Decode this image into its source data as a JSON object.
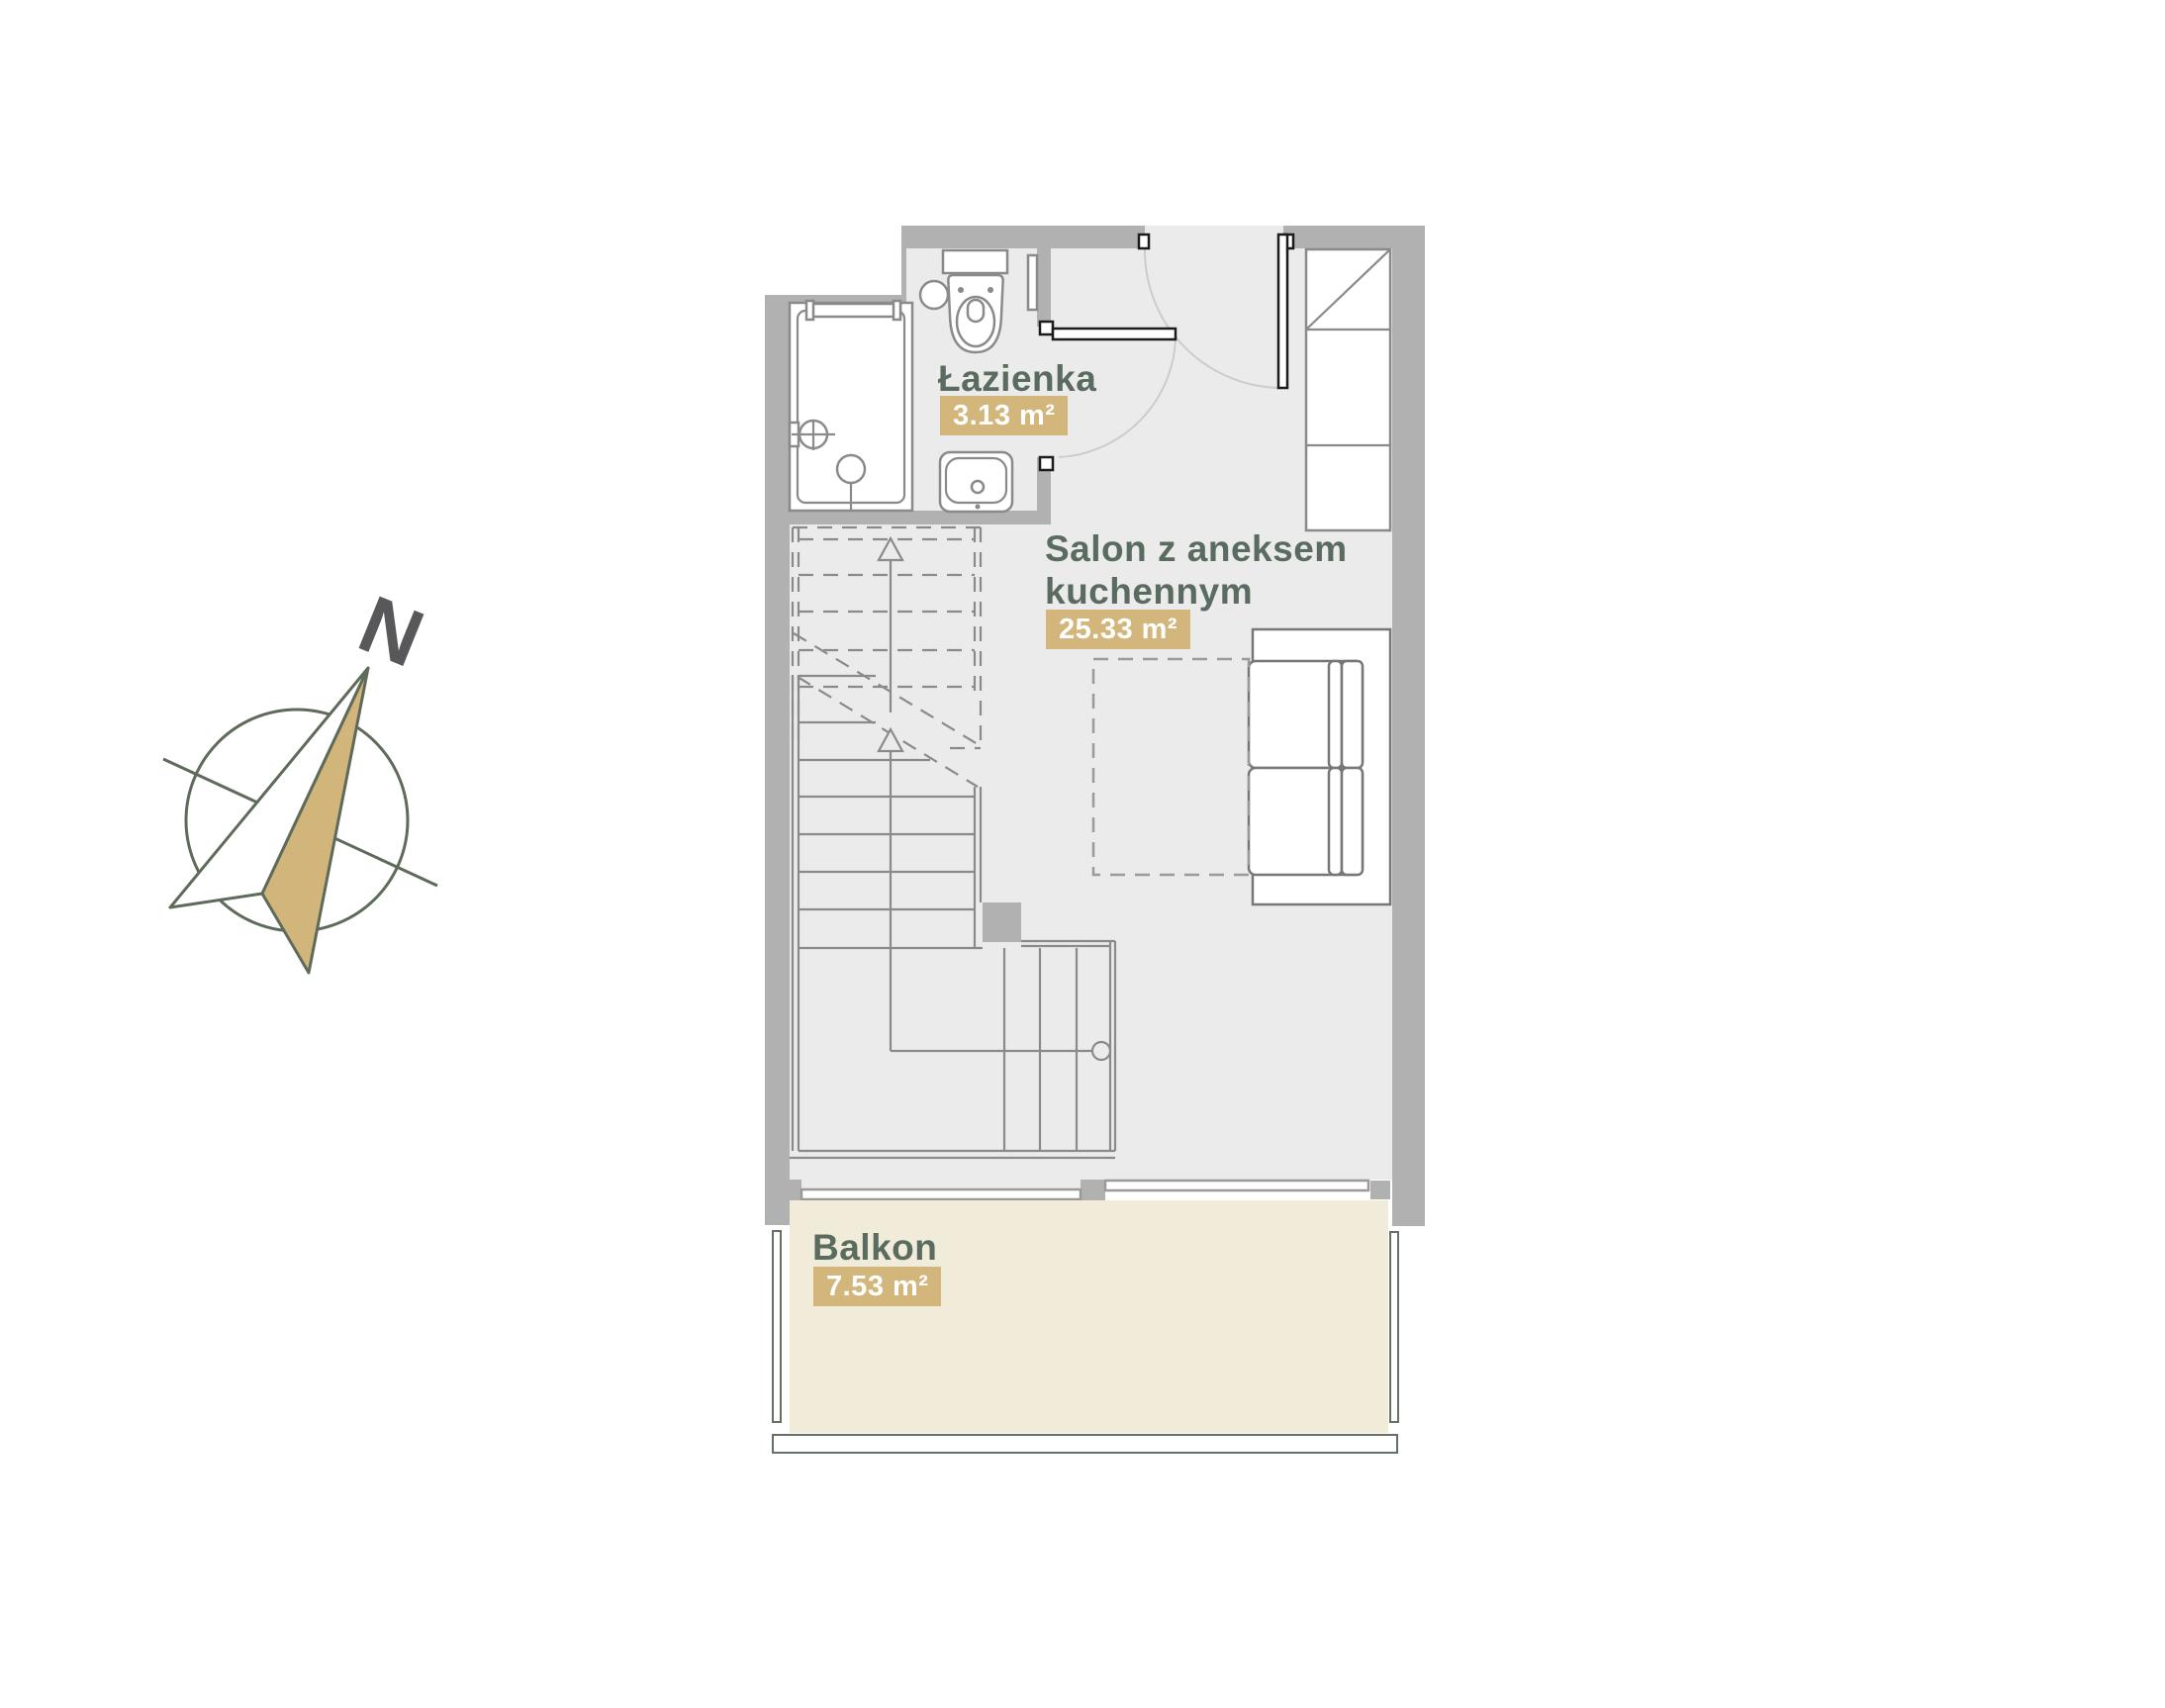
{
  "colors": {
    "wall": "#b1b1b1",
    "floor": "#ebebeb",
    "line": "#8a8a8a",
    "line_dark": "#777777",
    "label": "#5a6b60",
    "badge_bg": "#d3b67c",
    "badge_text": "#ffffff",
    "balcony": "#f1ecda",
    "railing": "#657064",
    "compass_outline": "#5f6b5a",
    "needle_fill": "#d2b57b",
    "north_text": "#58585a",
    "door": "#1c1c1c",
    "arc": "#cccccc",
    "window_line": "#9a9a9a"
  },
  "compass": {
    "label": "N"
  },
  "rooms": {
    "bathroom": {
      "name": "Łazienka",
      "area": "3.13 m²"
    },
    "living": {
      "name_line1": "Salon z aneksem",
      "name_line2": "kuchennym",
      "area": "25.33 m²"
    },
    "balcony": {
      "name": "Balkon",
      "area": "7.53 m²"
    }
  }
}
